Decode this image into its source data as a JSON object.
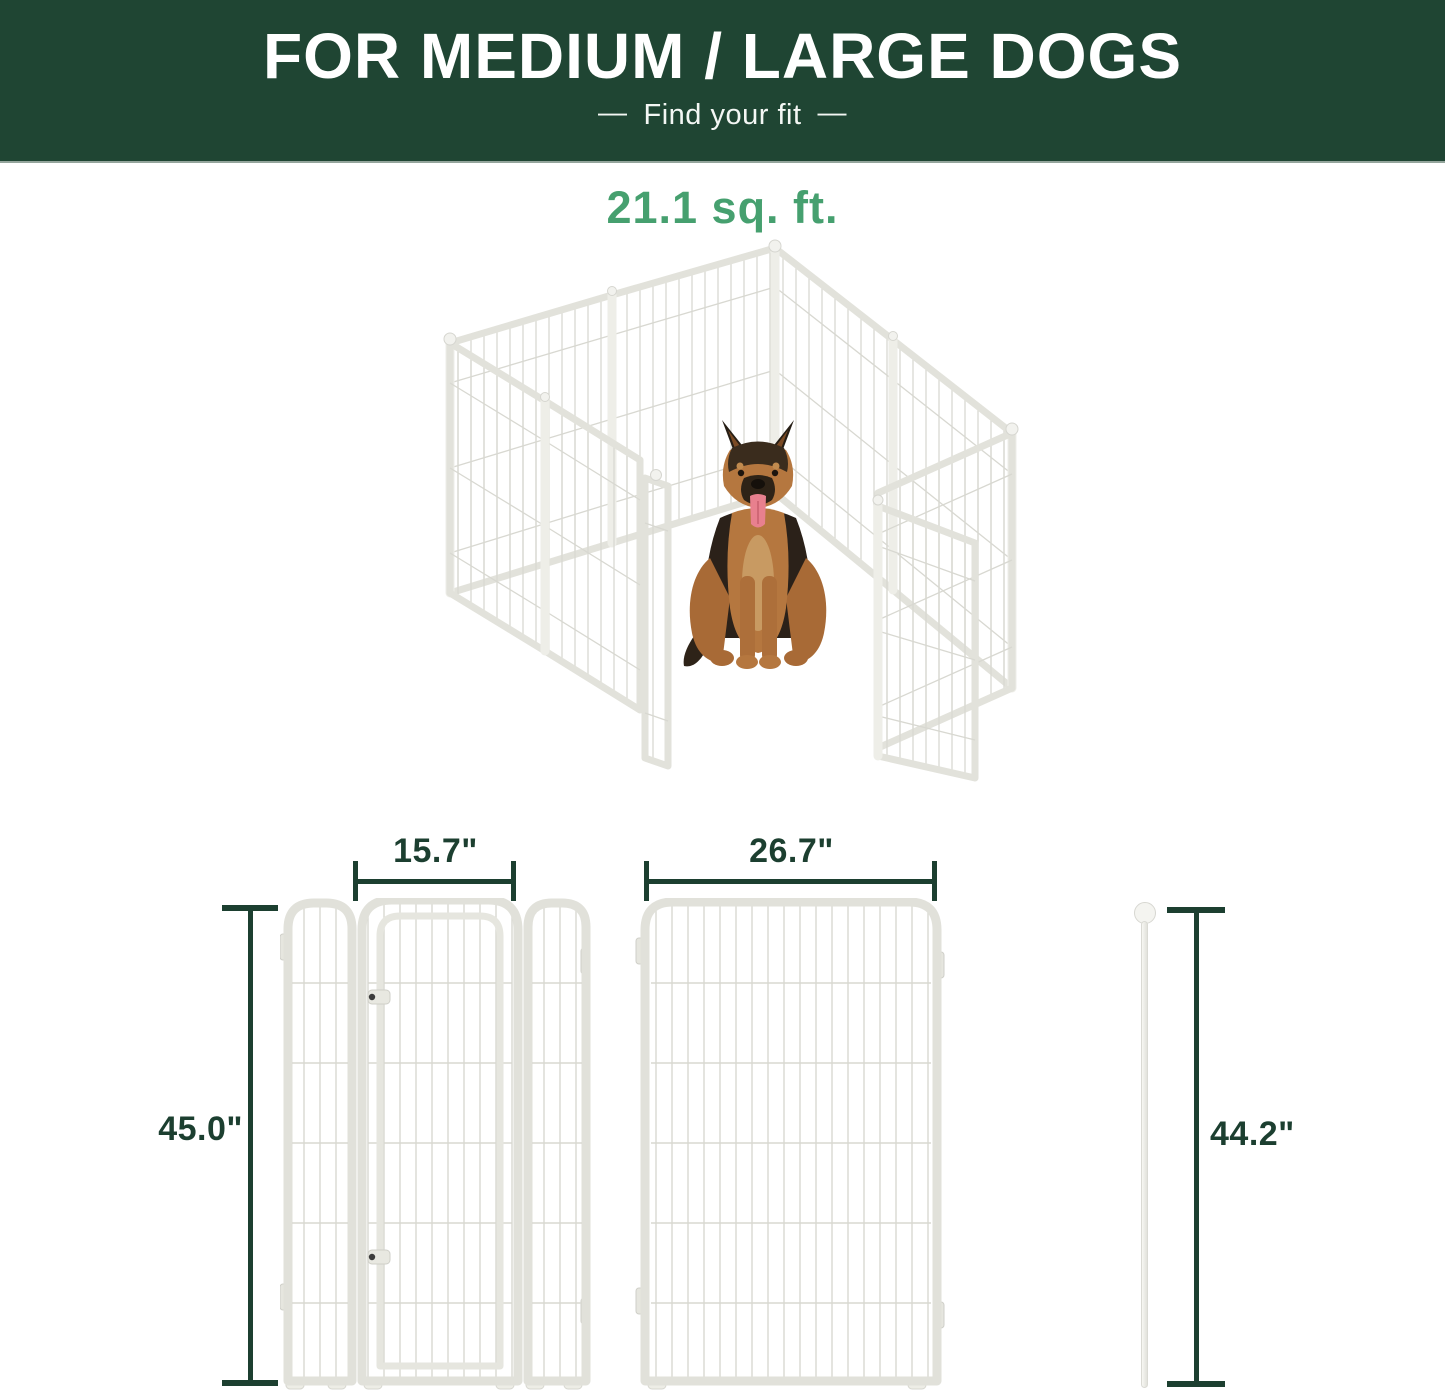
{
  "banner": {
    "title": "FOR MEDIUM / LARGE DOGS",
    "dash": "—",
    "subtitle": "Find your fit",
    "bg_color": "#1f4533",
    "text_color": "#ffffff"
  },
  "area": {
    "value": "21.1 sq. ft.",
    "color": "#46a06f"
  },
  "illustration": {
    "name": "white-metal-playpen-with-german-shepherd",
    "panel_color": "#e2e2db",
    "wire_color": "#d8d8d1"
  },
  "dimensions": {
    "door_section_width": "15.7\"",
    "large_panel_width": "26.7\"",
    "panel_height": "45.0\"",
    "rod_height": "44.2\"",
    "line_color": "#1c3f30"
  }
}
